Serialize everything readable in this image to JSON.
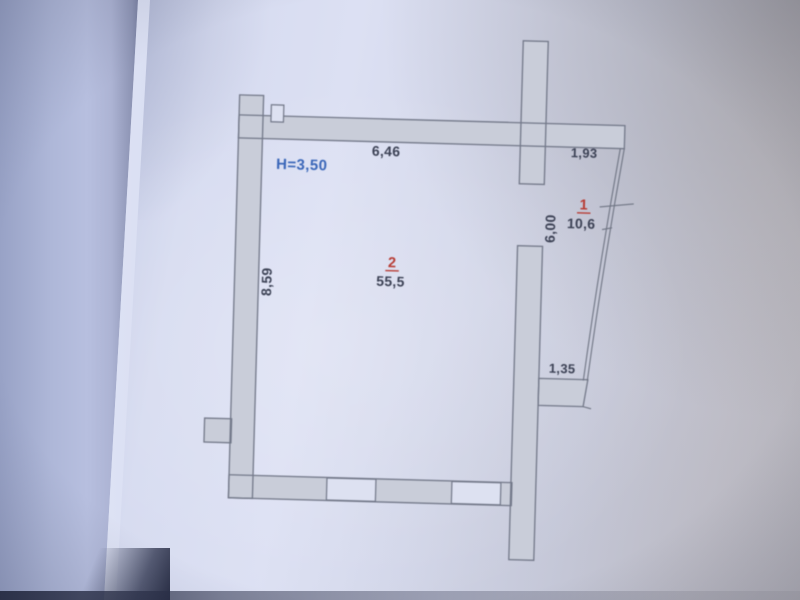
{
  "plan": {
    "height_label": "H=3,50",
    "dimensions": {
      "room_top_width": "6,46",
      "balcony_top_width": "1,93",
      "room_left_height": "8,59",
      "balcony_right_height": "6,00",
      "balcony_bottom_width": "1,35"
    },
    "rooms": [
      {
        "number": "1",
        "area": "10,6"
      },
      {
        "number": "2",
        "area": "55,5"
      }
    ],
    "colors": {
      "height_label_blue": "#3767c0",
      "room_number_red": "#c03a31",
      "dimension_text": "#3b4156",
      "wall_line": "#72788a",
      "wall_fill": "#c9cdda",
      "paper_light": "#dce0f3",
      "paper_shadow": "#98a2c6",
      "table_edge_dark": "#262b42"
    }
  }
}
